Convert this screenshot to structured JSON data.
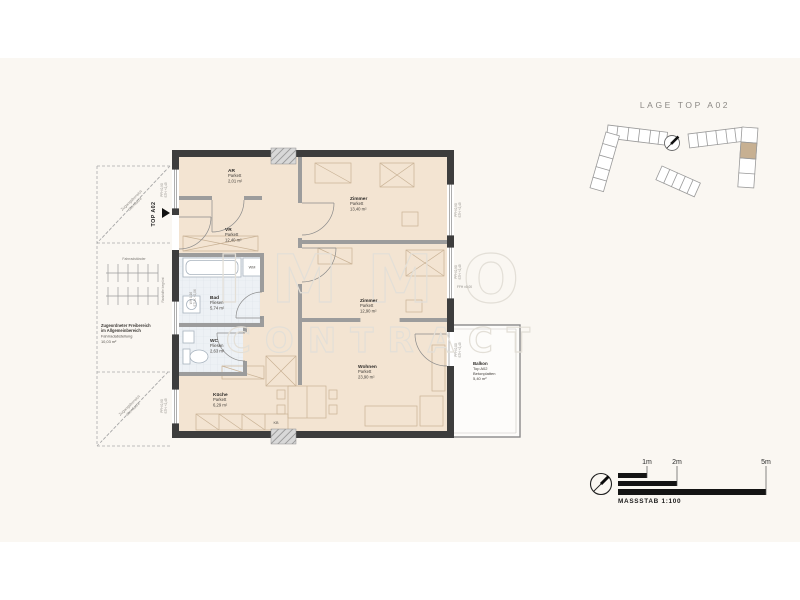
{
  "colors": {
    "page_band": "#faf7f2",
    "outer_wall": "#3d3d3d",
    "inner_wall": "#9c9c9c",
    "parkett_floor": "#f3e4d2",
    "fliesen_floor": "#edf1f5",
    "site_highlight": "#c7b092",
    "watermark": "#e3dfd7",
    "scalebar_black": "#141414"
  },
  "title": "LAGE TOP A02",
  "watermark": {
    "line1": "IMMO",
    "line2": "CONTRACT"
  },
  "scalebar": {
    "tick1": "1m",
    "tick2": "2m",
    "tick3": "5m",
    "caption": "MASSSTAB 1:100"
  },
  "rooms": [
    {
      "name": "AR",
      "floor": "Parkett",
      "area": "2,01 m²"
    },
    {
      "name": "VR",
      "floor": "Parkett",
      "area": "12,40 m²"
    },
    {
      "name": "Zimmer",
      "floor": "Parkett",
      "area": "13,40 m²"
    },
    {
      "name": "Bad",
      "floor": "Fliesen",
      "area": "5,74 m²"
    },
    {
      "name": "WC",
      "floor": "Fliesen",
      "area": "2,63 m²"
    },
    {
      "name": "Küche",
      "floor": "Parkett",
      "area": "6,29 m²"
    },
    {
      "name": "Zimmer",
      "floor": "Parkett",
      "area": "12,90 m²"
    },
    {
      "name": "Wohnen",
      "floor": "Parkett",
      "area": "23,90 m²"
    }
  ],
  "balcony": {
    "name": "Balkon",
    "unit": "Top A02",
    "floor": "Betonplatten",
    "area": "5,40 m²"
  },
  "fixtures": {
    "wm": "WM",
    "kb": "KB"
  },
  "annotations": {
    "entry": "TOP A02",
    "ffh": "FFH ±0,00",
    "diag_top_1": "Zugangsbereich",
    "diag_top_2": "überdacht",
    "diag_bottom_1": "Zugangsbereich",
    "diag_bottom_2": "überdacht",
    "bike": "Fahrradständer",
    "rank": "Rankhilfe begrünt",
    "free_1": "Zugeordneter Freibereich",
    "free_2": "im Allgemeinbereich",
    "free_3": "Fahrradabstellung",
    "free_4": "10,03 m²",
    "win_labels": [
      {
        "a": "PFH 0,90",
        "b": "STH +2,45"
      },
      {
        "a": "PFH 0,90",
        "b": "STH +2,45"
      },
      {
        "a": "PFH 0,00",
        "b": "STH +2,45"
      },
      {
        "a": "WH 1,16",
        "b": "STUK +2,06"
      },
      {
        "a": "PFH 0,90",
        "b": "STH +2,45"
      },
      {
        "a": "PFH 0,90",
        "b": "STH +2,45"
      }
    ]
  }
}
